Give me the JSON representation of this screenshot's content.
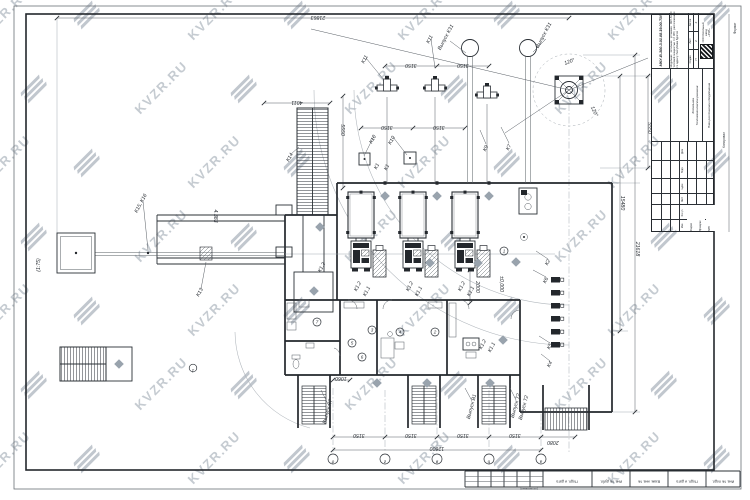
{
  "watermark": {
    "text": "KVZR.RU"
  },
  "frame": {
    "format_label": "Формат",
    "kopiroval_label": "Копировал",
    "soglasovano_label": "(согласовано)",
    "bottom_cells": [
      "Подп. и дата",
      "Инв. № дубл.",
      "Взам. инв. №",
      "Подп. и дата",
      "Инв. № подл."
    ]
  },
  "title_block": {
    "doc_number": "МКУ-В-300-3.01.08.19.00-ТМ",
    "description": "Модульная котельная установка МКУ-В-300 тепловой мощностью 0,3 МВт, расположенная по адресу: Республика Бурятия",
    "stage_label": "Стадия",
    "sheet_label": "Лист",
    "sheets_label": "Листов",
    "stage": "П",
    "sheet": "2",
    "sheets": "4",
    "object_name_1": "Котельная.",
    "object_name_2": "Тепломеханические решения",
    "sheet_title": "План расстановки оборудования",
    "company_lines": [
      "ООО Котельный",
      "завод",
      "«РЭП»"
    ],
    "header_cols": [
      "Изм.",
      "Кол.уч.",
      "Лист",
      "№док.",
      "Подп.",
      "Дата"
    ],
    "sig_rows": [
      "Разраб.",
      "Проверил",
      "ГИП"
    ]
  },
  "plan": {
    "level_mark": "±0,000",
    "dims": [
      {
        "t": "21863",
        "x": 318,
        "y": 16,
        "rot": 180
      },
      {
        "t": "4011",
        "x": 297,
        "y": 101,
        "rot": 180
      },
      {
        "t": "3150",
        "x": 411,
        "y": 64,
        "rot": 180
      },
      {
        "t": "3150",
        "x": 463,
        "y": 64,
        "rot": 180
      },
      {
        "t": "3150",
        "x": 387,
        "y": 126,
        "rot": 180
      },
      {
        "t": "3150",
        "x": 439,
        "y": 126,
        "rot": 180
      },
      {
        "t": "5550",
        "x": 341,
        "y": 130,
        "rot": 90
      },
      {
        "t": "5550",
        "x": 648,
        "y": 128,
        "rot": 90
      },
      {
        "t": "15480",
        "x": 621,
        "y": 203,
        "rot": 90
      },
      {
        "t": "21618",
        "x": 636,
        "y": 249,
        "rot": 90
      },
      {
        "t": "3150",
        "x": 359,
        "y": 434,
        "rot": 180
      },
      {
        "t": "3150",
        "x": 411,
        "y": 434,
        "rot": 180
      },
      {
        "t": "3150",
        "x": 463,
        "y": 434,
        "rot": 180
      },
      {
        "t": "3150",
        "x": 515,
        "y": 434,
        "rot": 180
      },
      {
        "t": "2080",
        "x": 553,
        "y": 441,
        "rot": 180
      },
      {
        "t": "12600",
        "x": 437,
        "y": 447,
        "rot": 180
      },
      {
        "t": "1060",
        "x": 341,
        "y": 377,
        "rot": 180
      },
      {
        "t": "2000",
        "x": 476,
        "y": 287,
        "rot": 90
      },
      {
        "t": "4.383",
        "x": 214,
        "y": 216,
        "rot": 90
      },
      {
        "t": "(1:75)",
        "x": 40,
        "y": 265,
        "rot": -90
      }
    ],
    "labels": [
      {
        "t": "Выпуск К31",
        "x": 447,
        "y": 38,
        "rot": -62
      },
      {
        "t": "Выпуск К31",
        "x": 545,
        "y": 36,
        "rot": -62
      },
      {
        "t": "К11",
        "x": 366,
        "y": 60,
        "rot": -62
      },
      {
        "t": "К11",
        "x": 431,
        "y": 40,
        "rot": -62
      },
      {
        "t": "К7",
        "x": 510,
        "y": 148,
        "rot": -62
      },
      {
        "t": "К9",
        "x": 487,
        "y": 149,
        "rot": -62
      },
      {
        "t": "К10",
        "x": 374,
        "y": 140,
        "rot": -62
      },
      {
        "t": "К10",
        "x": 393,
        "y": 141,
        "rot": -62
      },
      {
        "t": "К1",
        "x": 378,
        "y": 167,
        "rot": -62
      },
      {
        "t": "К1",
        "x": 388,
        "y": 168,
        "rot": -62
      },
      {
        "t": "К14",
        "x": 291,
        "y": 158,
        "rot": -62
      },
      {
        "t": "К15, К16",
        "x": 142,
        "y": 204,
        "rot": -62
      },
      {
        "t": "К13",
        "x": 201,
        "y": 293,
        "rot": -62
      },
      {
        "t": "К1.2",
        "x": 323,
        "y": 268,
        "rot": -62
      },
      {
        "t": "К1.2",
        "x": 359,
        "y": 287,
        "rot": -62
      },
      {
        "t": "К1.1",
        "x": 368,
        "y": 292,
        "rot": -62
      },
      {
        "t": "К1.2",
        "x": 411,
        "y": 287,
        "rot": -62
      },
      {
        "t": "К1.1",
        "x": 420,
        "y": 292,
        "rot": -62
      },
      {
        "t": "К1.2",
        "x": 463,
        "y": 287,
        "rot": -62
      },
      {
        "t": "К1.1",
        "x": 472,
        "y": 292,
        "rot": -62
      },
      {
        "t": "К1.2",
        "x": 484,
        "y": 345,
        "rot": -62
      },
      {
        "t": "К1.1",
        "x": 493,
        "y": 348,
        "rot": -62
      },
      {
        "t": "К2",
        "x": 549,
        "y": 263,
        "rot": -62
      },
      {
        "t": "К6",
        "x": 547,
        "y": 281,
        "rot": -62
      },
      {
        "t": "К5",
        "x": 551,
        "y": 347,
        "rot": -62
      },
      {
        "t": "К4",
        "x": 551,
        "y": 365,
        "rot": -62
      },
      {
        "t": "Выпуск К7",
        "x": 329,
        "y": 412,
        "rot": -75
      },
      {
        "t": "Выпуск В1",
        "x": 473,
        "y": 407,
        "rot": -75
      },
      {
        "t": "Выпуск Т2",
        "x": 517,
        "y": 406,
        "rot": -75
      },
      {
        "t": "Выпуск Т2",
        "x": 525,
        "y": 408,
        "rot": -75
      },
      {
        "t": "120°",
        "x": 570,
        "y": 63,
        "rot": -20
      },
      {
        "t": "120°",
        "x": 593,
        "y": 112,
        "rot": 65
      },
      {
        "t": "±0,000",
        "x": 500,
        "y": 284,
        "rot": 90
      }
    ],
    "axis_bubbles": [
      {
        "t": "д",
        "x": 333
      },
      {
        "t": "г",
        "x": 385
      },
      {
        "t": "в",
        "x": 437
      },
      {
        "t": "б",
        "x": 489
      },
      {
        "t": "а",
        "x": 541
      }
    ],
    "side_bubble": {
      "t": "1",
      "x": 193,
      "y": 368
    },
    "room_numbers": [
      {
        "t": "1",
        "x": 504,
        "y": 251
      },
      {
        "t": "2",
        "x": 435,
        "y": 332
      },
      {
        "t": "3",
        "x": 372,
        "y": 330
      },
      {
        "t": "4",
        "x": 400,
        "y": 332
      },
      {
        "t": "5",
        "x": 352,
        "y": 343
      },
      {
        "t": "6",
        "x": 362,
        "y": 357
      },
      {
        "t": "7",
        "x": 317,
        "y": 322
      }
    ]
  }
}
